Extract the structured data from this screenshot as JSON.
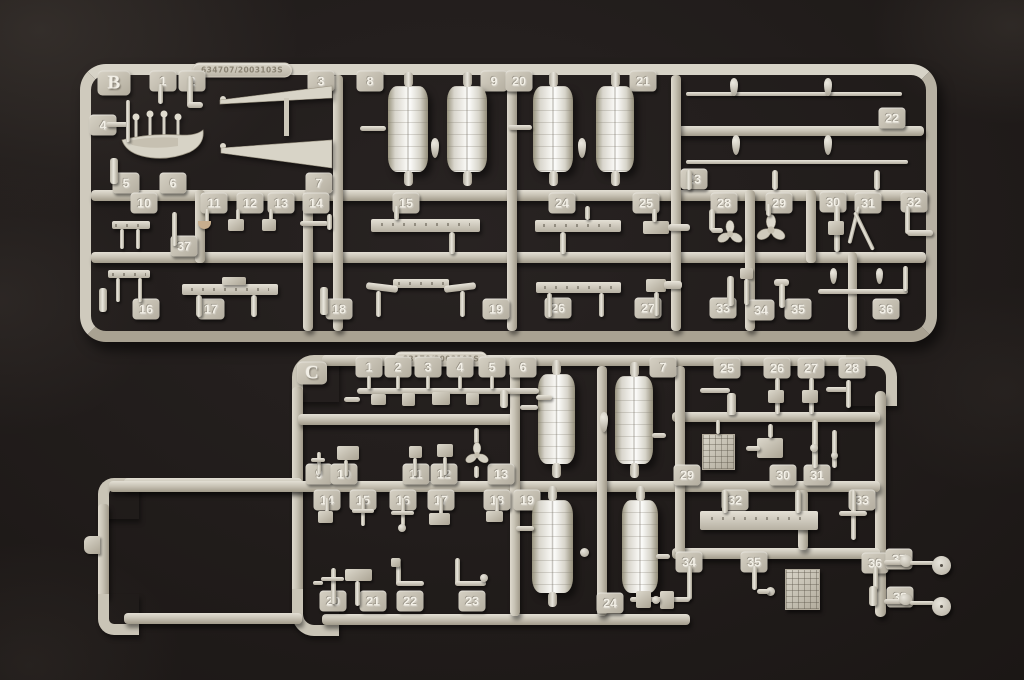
{
  "colors": {
    "plastic_light": "#e9e6dc",
    "plastic": "#cdc8bb",
    "plastic_dark": "#a49d8d",
    "background": "#171311"
  },
  "sprues": [
    {
      "id": "B",
      "label": "B",
      "mold_code": "634707/2003103S",
      "part_tabs": [
        {
          "n": "1",
          "x": 163,
          "y": 81
        },
        {
          "n": "2",
          "x": 192,
          "y": 81
        },
        {
          "n": "3",
          "x": 321,
          "y": 81
        },
        {
          "n": "8",
          "x": 370,
          "y": 81
        },
        {
          "n": "9",
          "x": 494,
          "y": 81
        },
        {
          "n": "20",
          "x": 519,
          "y": 81
        },
        {
          "n": "21",
          "x": 643,
          "y": 81
        },
        {
          "n": "4",
          "x": 103,
          "y": 125
        },
        {
          "n": "22",
          "x": 892,
          "y": 118
        },
        {
          "n": "5",
          "x": 126,
          "y": 183
        },
        {
          "n": "6",
          "x": 173,
          "y": 183
        },
        {
          "n": "7",
          "x": 319,
          "y": 183
        },
        {
          "n": "23",
          "x": 694,
          "y": 179
        },
        {
          "n": "10",
          "x": 144,
          "y": 203
        },
        {
          "n": "11",
          "x": 214,
          "y": 203
        },
        {
          "n": "12",
          "x": 250,
          "y": 203
        },
        {
          "n": "13",
          "x": 281,
          "y": 203
        },
        {
          "n": "14",
          "x": 316,
          "y": 203
        },
        {
          "n": "15",
          "x": 406,
          "y": 203
        },
        {
          "n": "24",
          "x": 562,
          "y": 203
        },
        {
          "n": "25",
          "x": 646,
          "y": 203
        },
        {
          "n": "28",
          "x": 724,
          "y": 203
        },
        {
          "n": "29",
          "x": 779,
          "y": 203
        },
        {
          "n": "30",
          "x": 833,
          "y": 202
        },
        {
          "n": "31",
          "x": 868,
          "y": 203
        },
        {
          "n": "32",
          "x": 914,
          "y": 202
        },
        {
          "n": "37",
          "x": 184,
          "y": 246
        },
        {
          "n": "16",
          "x": 146,
          "y": 309
        },
        {
          "n": "17",
          "x": 211,
          "y": 309
        },
        {
          "n": "18",
          "x": 339,
          "y": 309
        },
        {
          "n": "19",
          "x": 496,
          "y": 309
        },
        {
          "n": "26",
          "x": 558,
          "y": 308
        },
        {
          "n": "27",
          "x": 648,
          "y": 308
        },
        {
          "n": "33",
          "x": 723,
          "y": 308
        },
        {
          "n": "34",
          "x": 761,
          "y": 310
        },
        {
          "n": "35",
          "x": 798,
          "y": 309
        },
        {
          "n": "36",
          "x": 886,
          "y": 309
        }
      ]
    },
    {
      "id": "C",
      "label": "C",
      "mold_code": "83170/2003101S",
      "part_tabs": [
        {
          "n": "1",
          "x": 369,
          "y": 367
        },
        {
          "n": "2",
          "x": 398,
          "y": 367
        },
        {
          "n": "3",
          "x": 428,
          "y": 367
        },
        {
          "n": "4",
          "x": 460,
          "y": 367
        },
        {
          "n": "5",
          "x": 492,
          "y": 367
        },
        {
          "n": "6",
          "x": 523,
          "y": 367
        },
        {
          "n": "7",
          "x": 663,
          "y": 367
        },
        {
          "n": "25",
          "x": 727,
          "y": 368
        },
        {
          "n": "26",
          "x": 777,
          "y": 368
        },
        {
          "n": "27",
          "x": 811,
          "y": 368
        },
        {
          "n": "28",
          "x": 852,
          "y": 368
        },
        {
          "n": "9",
          "x": 319,
          "y": 474
        },
        {
          "n": "10",
          "x": 344,
          "y": 474
        },
        {
          "n": "11",
          "x": 416,
          "y": 474
        },
        {
          "n": "12",
          "x": 444,
          "y": 474
        },
        {
          "n": "13",
          "x": 501,
          "y": 474
        },
        {
          "n": "29",
          "x": 687,
          "y": 475
        },
        {
          "n": "30",
          "x": 783,
          "y": 475
        },
        {
          "n": "31",
          "x": 817,
          "y": 475
        },
        {
          "n": "14",
          "x": 327,
          "y": 500
        },
        {
          "n": "15",
          "x": 363,
          "y": 500
        },
        {
          "n": "16",
          "x": 403,
          "y": 500
        },
        {
          "n": "17",
          "x": 441,
          "y": 500
        },
        {
          "n": "18",
          "x": 497,
          "y": 500
        },
        {
          "n": "19",
          "x": 527,
          "y": 500
        },
        {
          "n": "32",
          "x": 735,
          "y": 500
        },
        {
          "n": "33",
          "x": 862,
          "y": 500
        },
        {
          "n": "20",
          "x": 333,
          "y": 601
        },
        {
          "n": "21",
          "x": 373,
          "y": 601
        },
        {
          "n": "22",
          "x": 410,
          "y": 601
        },
        {
          "n": "23",
          "x": 472,
          "y": 601
        },
        {
          "n": "24",
          "x": 610,
          "y": 603
        },
        {
          "n": "34",
          "x": 689,
          "y": 562
        },
        {
          "n": "35",
          "x": 754,
          "y": 562
        },
        {
          "n": "36",
          "x": 875,
          "y": 563
        },
        {
          "n": "37",
          "x": 899,
          "y": 559
        },
        {
          "n": "38",
          "x": 900,
          "y": 597
        }
      ]
    }
  ]
}
